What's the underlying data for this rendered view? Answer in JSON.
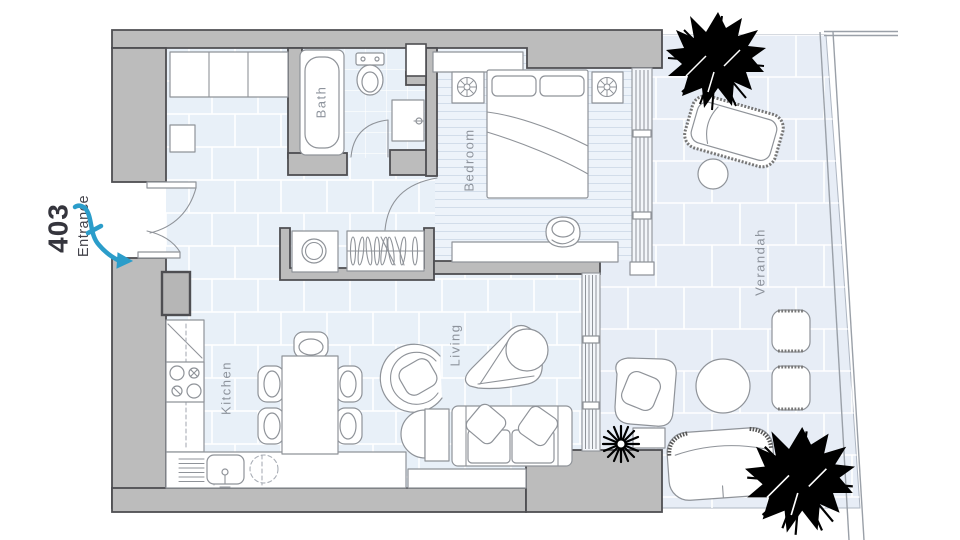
{
  "plan": {
    "unit_number": "403",
    "entrance_label": "Entrance",
    "rooms": {
      "bath": "Bath",
      "bedroom": "Bedroom",
      "kitchen": "Kitchen",
      "living": "Living",
      "verandah": "Verandah"
    },
    "colors": {
      "wall_fill": "#bcbcbc",
      "wall_outline": "#4e4e52",
      "floor_tile": "#e8f0f8",
      "bath_tile": "#e8f0f8",
      "verandah_tile": "#e7edf6",
      "bedroom_floor": "#edf3fa",
      "furniture_line": "#8f9399",
      "room_label": "#8d939c",
      "unit_label": "#35353d",
      "entrance_arrow": "#2b9dca",
      "tree": "#000000"
    }
  }
}
